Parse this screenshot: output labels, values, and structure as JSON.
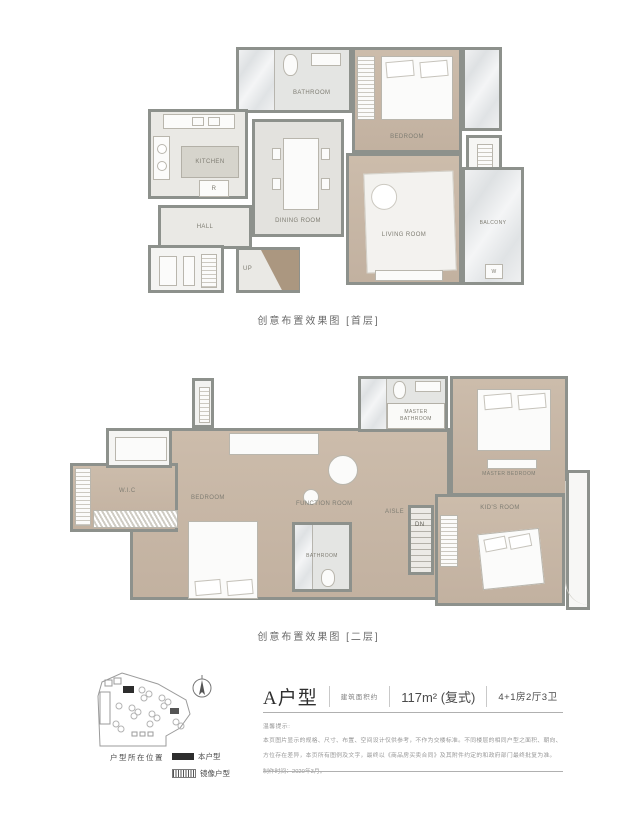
{
  "plans": {
    "first": {
      "caption": "创意布置效果图 [首层]",
      "rooms": {
        "bathroom": "BATHROOM",
        "bedroom": "BEDROOM",
        "kitchen": "KITCHEN",
        "fridge": "R",
        "dining_room": "DINING ROOM",
        "living_room": "LIVING ROOM",
        "balcony": "BALCONY",
        "washer": "W",
        "hall": "HALL",
        "stairs_up": "UP"
      }
    },
    "second": {
      "caption": "创意布置效果图 [二层]",
      "rooms": {
        "wic": "W.I.C",
        "bedroom": "BEDROOM",
        "master_bathroom": "MASTER BATHROOM",
        "master_bedroom": "MASTER BEDROOM",
        "function_room": "FUNCTION ROOM",
        "aisle": "AISLE",
        "stairs_down": "DN",
        "bathroom": "BATHROOM",
        "kids_room": "KID'S ROOM"
      }
    }
  },
  "site_plan": {
    "legend_title": "户型所在位置",
    "legend_this_unit": "本户型",
    "legend_mirror_unit": "镜像户型"
  },
  "unit_info": {
    "name": "A户型",
    "area_label": "建筑面积约",
    "area_value": "117m² (复式)",
    "layout_value": "4+1房2厅3卫"
  },
  "notes": {
    "heading": "温馨提示:",
    "body": "本页图片显示的规格、尺寸、布置、空间设计仅供参考，不作为交楼标准。不同楼层的相同户型之面积、朝向、方位存在差异，本页所有图例及文字，最终以《商品房买卖合同》及其附件约定的和政府部门最终批复为准。",
    "made_date": "制作时间：2020年3月。"
  },
  "colors": {
    "wall": "#8d918c",
    "wood_floor": "#c7b6a5",
    "accent_black": "#2d2d2d"
  }
}
